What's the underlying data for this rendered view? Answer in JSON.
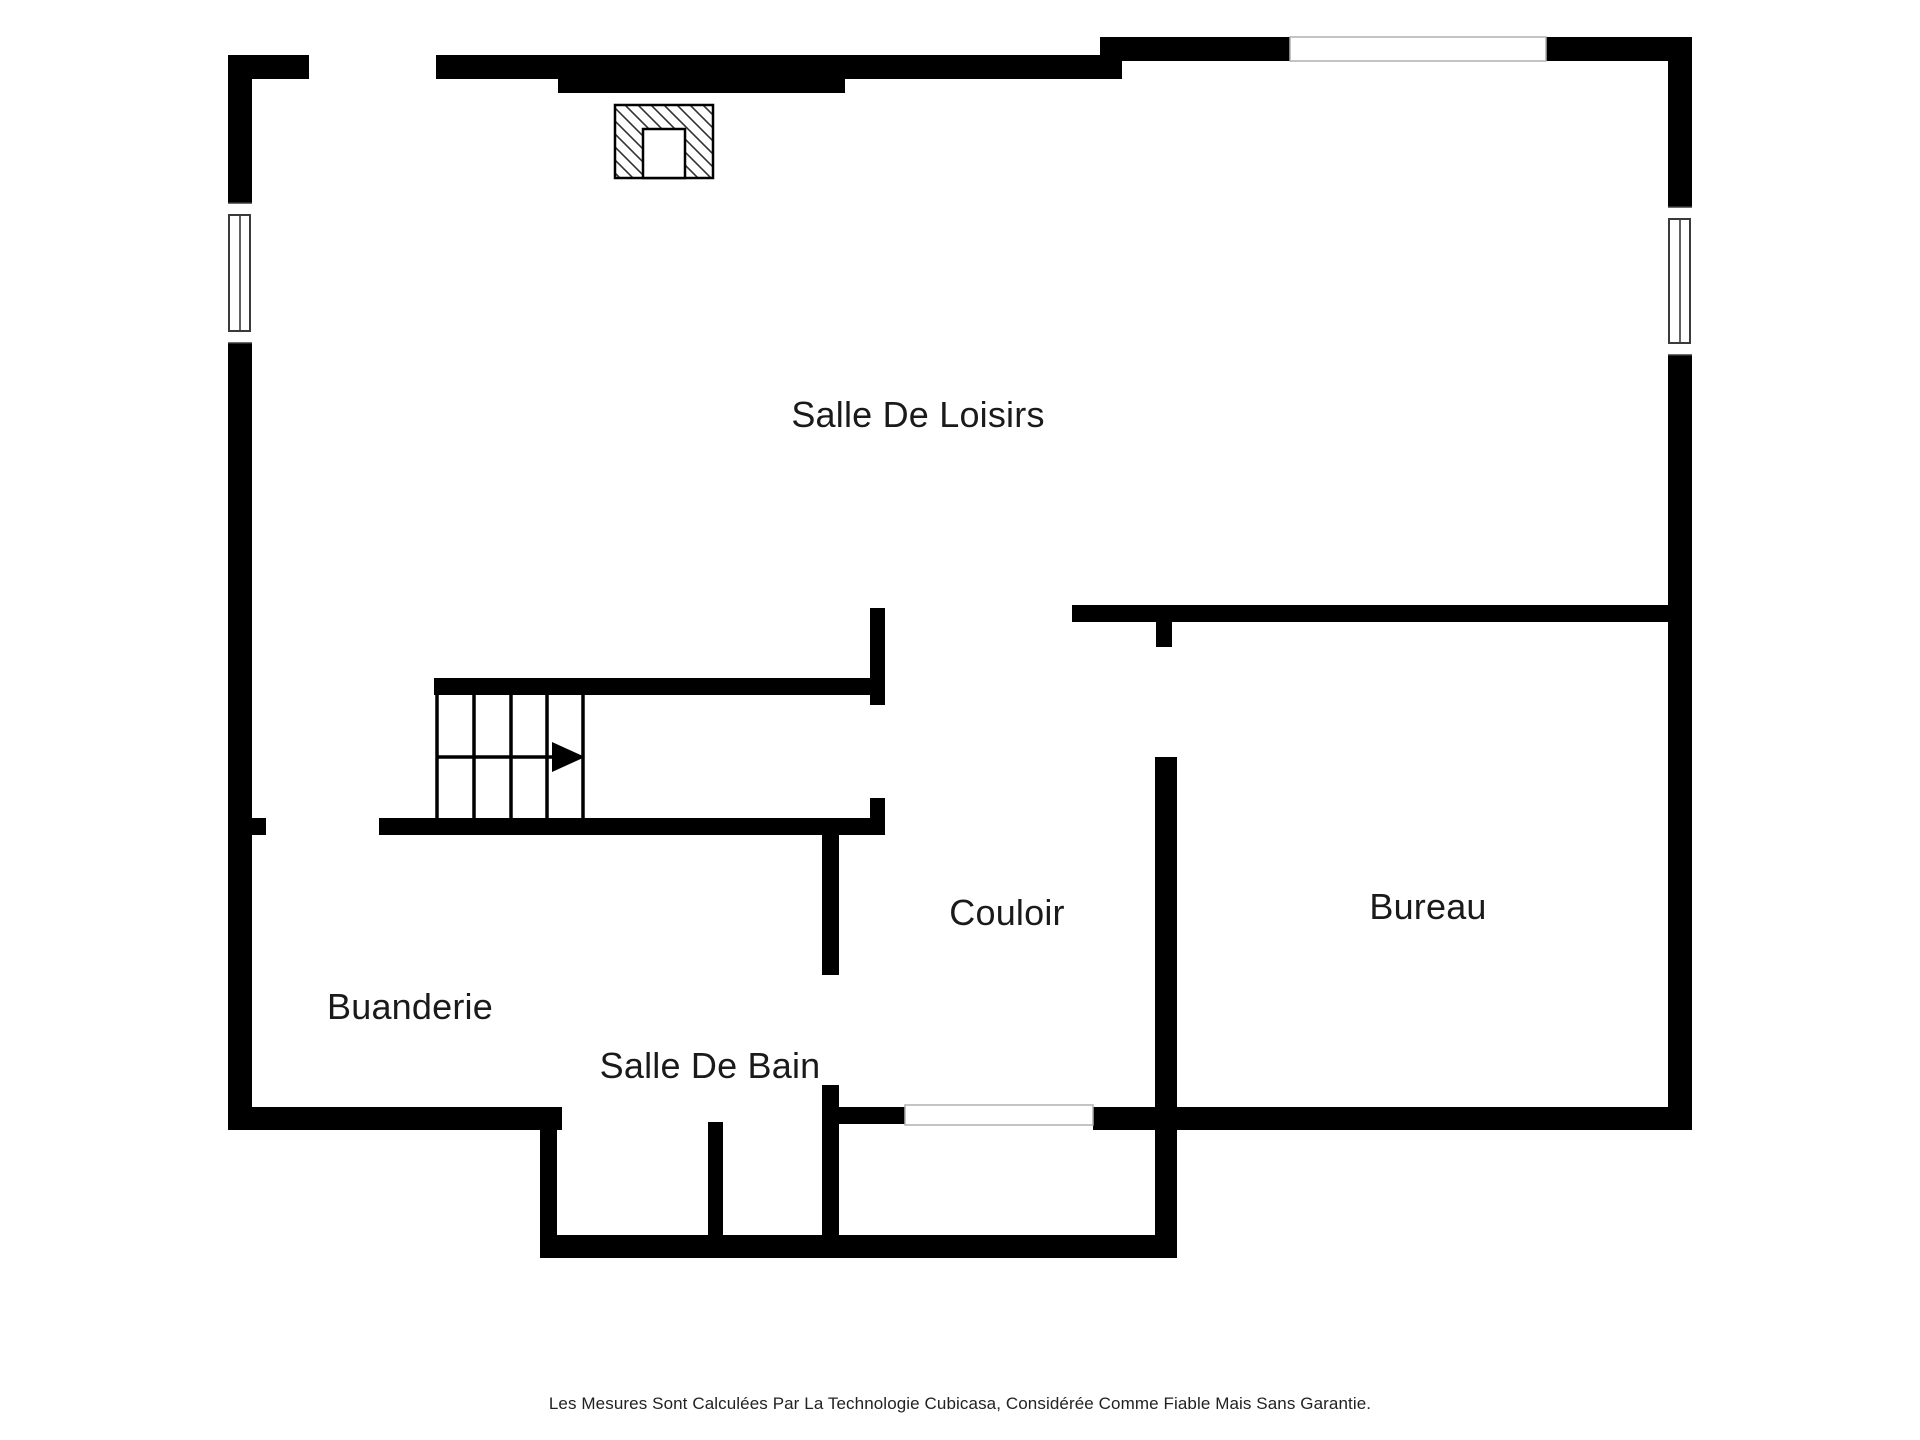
{
  "page": {
    "background_color": "#ffffff",
    "wall_color": "#000000",
    "text_color": "#1a1a1a",
    "opening_outline_color": "#b0b0b0",
    "window_frame_color": "#3a3a3a"
  },
  "floor_plan": {
    "rooms": [
      {
        "label": "Salle De Loisirs"
      },
      {
        "label": "Couloir"
      },
      {
        "label": "Bureau"
      },
      {
        "label": "Buanderie"
      },
      {
        "label": "Salle De Bain"
      }
    ],
    "symbols": {
      "fireplace": "hatched-rectangle-with-inner-flue",
      "stairs": "four-tread-staircase",
      "stair_direction": "arrow-pointing-right",
      "windows": [
        "left-wall-window",
        "right-wall-window"
      ],
      "openings": [
        "top-left-doorway",
        "top-right-opening",
        "laundry-doorway",
        "bathroom-hall-doorway",
        "office-doorway",
        "hall-bottom-doorway"
      ]
    }
  },
  "footer": {
    "disclaimer": "Les Mesures Sont Calculées Par La Technologie Cubicasa, Considérée Comme Fiable Mais Sans Garantie."
  }
}
